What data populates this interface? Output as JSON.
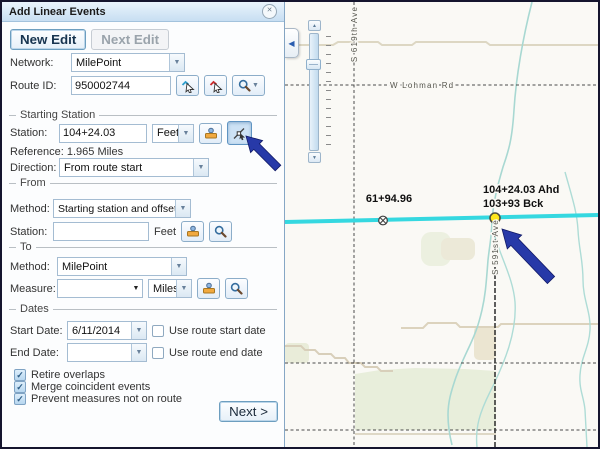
{
  "icons": {
    "close": "✕",
    "caret": "▼",
    "collapse_left": "◀",
    "slider_up": "▲",
    "slider_down": "▼",
    "check": "✓"
  },
  "panel": {
    "title": "Add Linear Events",
    "new_edit": "New Edit",
    "next_edit": "Next Edit",
    "network_label": "Network:",
    "network_value": "MilePoint",
    "route_id_label": "Route ID:",
    "route_id_value": "950002744",
    "starting_station": {
      "section": "Starting Station",
      "station_label": "Station:",
      "station_value": "104+24.03",
      "units": "Feet",
      "reference": "Reference: 1.965 Miles",
      "direction_label": "Direction:",
      "direction_value": "From route start"
    },
    "from": {
      "section": "From",
      "method_label": "Method:",
      "method_value": "Starting station and offset",
      "station_label": "Station:",
      "station_value": "",
      "units": "Feet"
    },
    "to": {
      "section": "To",
      "method_label": "Method:",
      "method_value": "MilePoint",
      "measure_label": "Measure:",
      "measure_value": "",
      "units": "Miles"
    },
    "dates": {
      "section": "Dates",
      "start_label": "Start Date:",
      "start_value": "6/11/2014",
      "use_start": "Use route start date",
      "end_label": "End Date:",
      "end_value": "",
      "use_end": "Use route end date"
    },
    "options": [
      {
        "label": "Retire overlaps",
        "checked": true
      },
      {
        "label": "Merge coincident events",
        "checked": true
      },
      {
        "label": "Prevent measures not on route",
        "checked": true
      }
    ],
    "next_button": "Next >"
  },
  "map": {
    "route_color": "#35d8e0",
    "station_label_left": "61+94.96",
    "station_label_right_line1": "104+24.03 Ahd",
    "station_label_right_line2": "103+93 Bck",
    "road_label_horizontal": "W Lohman Rd",
    "road_label_vertical_left": "S 619th Ave",
    "road_label_vertical_right": "S 591st Ave",
    "annotation_color": "#2739a8"
  }
}
